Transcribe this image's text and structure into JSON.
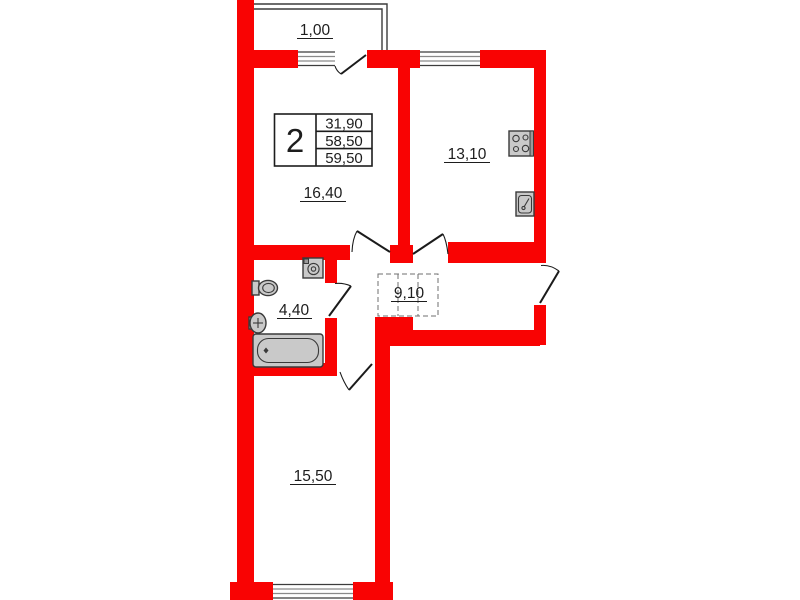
{
  "floor_plan": {
    "summary_table": {
      "rooms_count": "2",
      "areas": [
        "31,90",
        "58,50",
        "59,50"
      ]
    },
    "rooms": {
      "balcony": {
        "area": "1,00"
      },
      "living_room": {
        "area": "16,40"
      },
      "kitchen": {
        "area": "13,10"
      },
      "bathroom": {
        "area": "4,40"
      },
      "hallway": {
        "area": "9,10"
      },
      "bedroom": {
        "area": "15,50"
      }
    },
    "icons": [
      "stove-icon",
      "kitchen-sink-icon",
      "washing-machine-icon",
      "toilet-icon",
      "washbasin-icon",
      "bathtub-icon",
      "wardrobe-dashed-icon"
    ],
    "colors": {
      "wall": "#f90303",
      "fixture_fill": "#c9c9c9",
      "linework": "#1d1d1d",
      "background": "#ffffff"
    }
  }
}
